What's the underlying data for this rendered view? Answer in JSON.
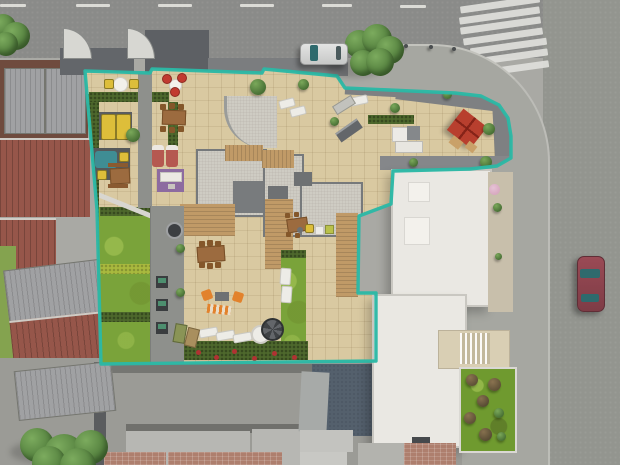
{
  "meta": {
    "title": "Aerial 3D architectural rendering of a residential building plot",
    "view": "top-down site plan render",
    "no_visible_text": true
  },
  "scene": {
    "colors": {
      "boundary_teal": "#2bb8a6",
      "road": "#8a8b89",
      "road_right": "#93958f",
      "sidewalk": "#a9a9a4",
      "sidewalk_corner": "#a6a7a1",
      "alley": "#9b9b96",
      "terrace": "#d9c9a1",
      "gravel_light": "#d2cfc6",
      "gravel_dark": "#7e8082",
      "wood": "#c09a67",
      "lawn": "#7aa33a",
      "hedge": "#4e682c",
      "hedge_light": "#a9b93e",
      "white_roof": "#eae8e3",
      "white_roof_edge": "#c9c7c1",
      "slate_court": "#54606d",
      "red_roof": "#96564a",
      "gray_roof": "#a0a1a3",
      "gray_roof_line": "#8b8c8e",
      "brick": "#ae7f6e",
      "slab": "#b7b7b3",
      "red_parasol": "#b83f2e",
      "purple": "#8d6ba0",
      "orange": "#e2822c",
      "yellow": "#ddbe3a",
      "teal_item": "#3f8d94",
      "car_red": "#8e424d",
      "car_silver": "#d6d7d6",
      "glass": "#2e6a6d",
      "tree_green": "#5d8f46",
      "flower_red": "#b03232",
      "pink_blossom": "#d8a9c0"
    },
    "counts": {
      "lane_dashes": 6,
      "crosswalk_stripes": 7,
      "cars": 2,
      "trees_street": 2,
      "tree_bottom": 1,
      "garden_plots_left": 3,
      "planters_on_path": 3,
      "red_flower_clusters": 6
    },
    "objects": [
      "teal property boundary outline",
      "rooftop terraces with tiled paving",
      "white round table with two yellow chairs",
      "red bistro chair set",
      "pair of yellow sun loungers",
      "teal lounge pad with yellow seats",
      "wooden six-seat dining table (upper terrace)",
      "wooden bench set",
      "red loungers with purple rug and white sofa",
      "white loungers with side table (top terrace)",
      "gray bench and gray lounger (middle terrace)",
      "white and gray lounge set (right terrace)",
      "red square parasol with seating",
      "wooden six-seat dining table (courtyard)",
      "orange armchairs with coffee table and striped lounger",
      "row of three white sun loungers",
      "papasan chair",
      "spiral staircase",
      "green courtyard lawns with hedge dividers",
      "gray garden path with dark planters and barbecue",
      "hedge with red flowers along courtyard edge",
      "large white flat-roof building with skylights",
      "inset stair courtyard and rooftop garden patch",
      "neighboring corrugated red and gray roofs",
      "street with dashed center line",
      "diagonal zebra crosswalk",
      "silver car parked on upper street",
      "red car parked on right street",
      "street trees and driveway gate fans"
    ]
  }
}
